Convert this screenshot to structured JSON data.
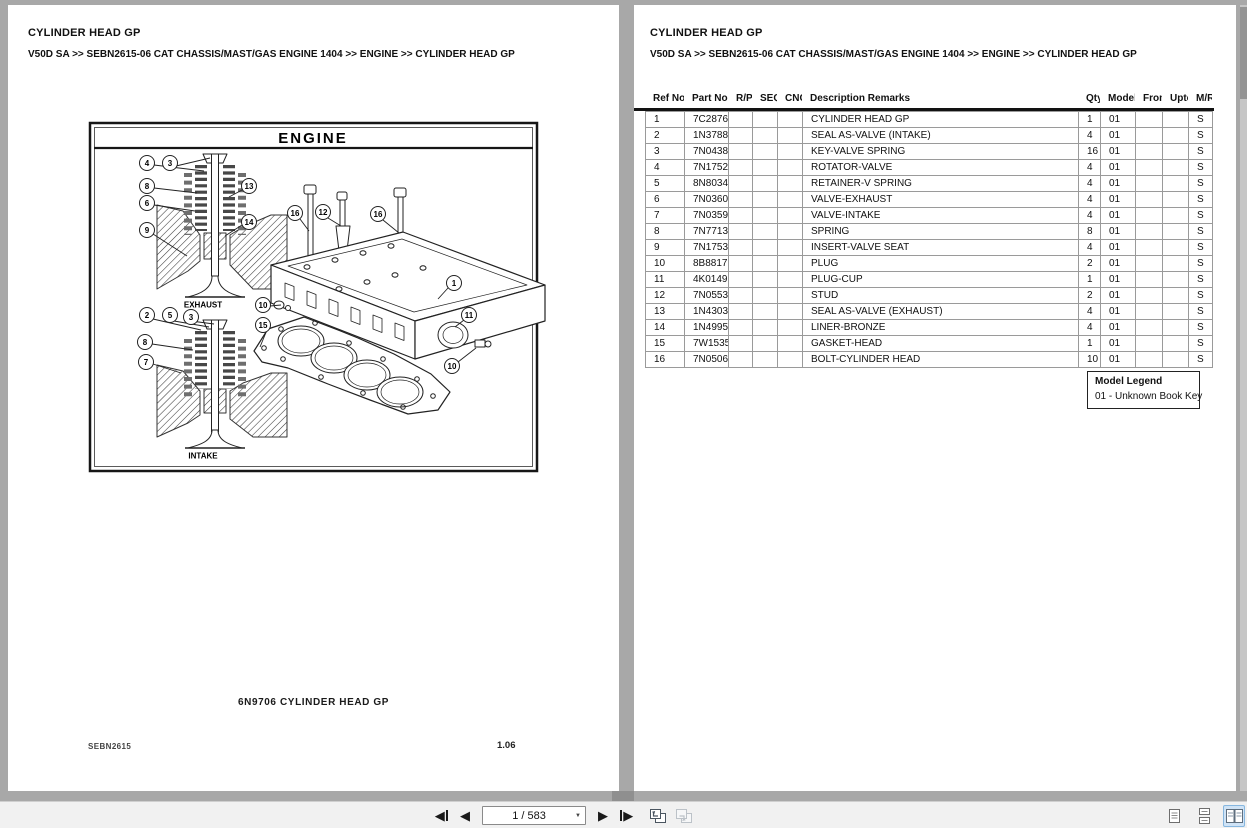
{
  "header": {
    "title": "CYLINDER HEAD GP",
    "breadcrumb": "V50D SA >> SEBN2615-06 CAT CHASSIS/MAST/GAS ENGINE 1404 >> ENGINE >> CYLINDER HEAD GP"
  },
  "diagram": {
    "plate_title": "ENGINE",
    "exhaust_label": "EXHAUST",
    "intake_label": "INTAKE",
    "caption": "6N9706  CYLINDER HEAD GP",
    "doc_code": "SEBN2615",
    "page_code": "1.06",
    "callouts": [
      "4",
      "3",
      "8",
      "6",
      "9",
      "13",
      "14",
      "2",
      "5",
      "3",
      "8",
      "7",
      "16",
      "12",
      "16",
      "1",
      "10",
      "15",
      "11",
      "10"
    ]
  },
  "table": {
    "columns": [
      "Ref No.",
      "Part No.",
      "R/P",
      "SEQ",
      "CNG",
      "Description Remarks",
      "Qty",
      "Model",
      "From",
      "Upto",
      "M/R"
    ],
    "rows": [
      [
        "1",
        "7C2876",
        "",
        "",
        "",
        "CYLINDER HEAD GP",
        "1",
        "01",
        "",
        "",
        "S"
      ],
      [
        "2",
        "1N3788",
        "",
        "",
        "",
        "SEAL AS-VALVE (INTAKE)",
        "4",
        "01",
        "",
        "",
        "S"
      ],
      [
        "3",
        "7N0438",
        "",
        "",
        "",
        "KEY-VALVE SPRING",
        "16",
        "01",
        "",
        "",
        "S"
      ],
      [
        "4",
        "7N1752",
        "",
        "",
        "",
        "ROTATOR-VALVE",
        "4",
        "01",
        "",
        "",
        "S"
      ],
      [
        "5",
        "8N8034",
        "",
        "",
        "",
        "RETAINER-V SPRING",
        "4",
        "01",
        "",
        "",
        "S"
      ],
      [
        "6",
        "7N0360",
        "",
        "",
        "",
        "VALVE-EXHAUST",
        "4",
        "01",
        "",
        "",
        "S"
      ],
      [
        "7",
        "7N0359",
        "",
        "",
        "",
        "VALVE-INTAKE",
        "4",
        "01",
        "",
        "",
        "S"
      ],
      [
        "8",
        "7N7713",
        "",
        "",
        "",
        "SPRING",
        "8",
        "01",
        "",
        "",
        "S"
      ],
      [
        "9",
        "7N1753",
        "",
        "",
        "",
        "INSERT-VALVE SEAT",
        "4",
        "01",
        "",
        "",
        "S"
      ],
      [
        "10",
        "8B8817",
        "",
        "",
        "",
        "PLUG",
        "2",
        "01",
        "",
        "",
        "S"
      ],
      [
        "11",
        "4K0149",
        "",
        "",
        "",
        "PLUG-CUP",
        "1",
        "01",
        "",
        "",
        "S"
      ],
      [
        "12",
        "7N0553",
        "",
        "",
        "",
        "STUD",
        "2",
        "01",
        "",
        "",
        "S"
      ],
      [
        "13",
        "1N4303",
        "",
        "",
        "",
        "SEAL AS-VALVE (EXHAUST)",
        "4",
        "01",
        "",
        "",
        "S"
      ],
      [
        "14",
        "1N4995",
        "",
        "",
        "",
        "LINER-BRONZE",
        "4",
        "01",
        "",
        "",
        "S"
      ],
      [
        "15",
        "7W1535",
        "",
        "",
        "",
        "GASKET-HEAD",
        "1",
        "01",
        "",
        "",
        "S"
      ],
      [
        "16",
        "7N0506",
        "",
        "",
        "",
        "BOLT-CYLINDER HEAD",
        "10",
        "01",
        "",
        "",
        "S"
      ]
    ]
  },
  "legend": {
    "title": "Model Legend",
    "entries": [
      "01 - Unknown Book Key"
    ]
  },
  "toolbar": {
    "page_display": "1 / 583",
    "icons": {
      "left_triangle": "◀",
      "right_triangle": "▶",
      "dropdown_arrow": "▼"
    }
  },
  "colors": {
    "background": "#a8a8a8",
    "page": "#ffffff",
    "toolbar_bg": "#f1f1f1",
    "table_border": "#9a9a9a",
    "rule": "#121212",
    "selected_view_bg": "#cfe3f6",
    "selected_view_border": "#86b7e0"
  }
}
